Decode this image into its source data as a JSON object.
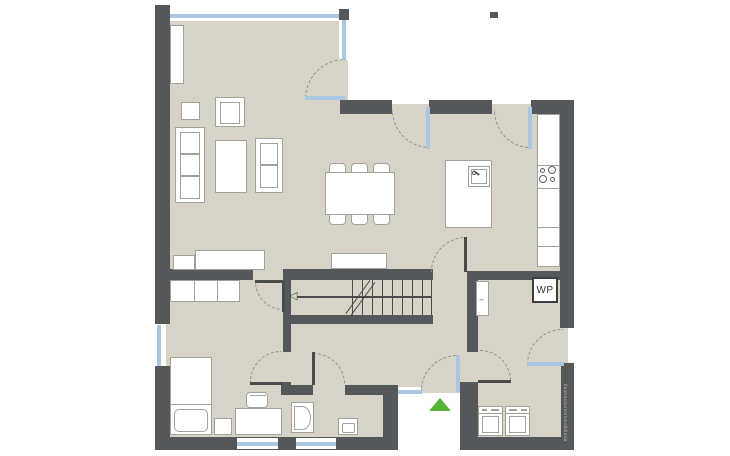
{
  "canvas": {
    "width": 730,
    "height": 456,
    "background": "#ffffff"
  },
  "labels": {
    "heat_pump": "WP",
    "watermark": "ilustracionesinmobiliaria"
  },
  "icons": {
    "stair_direction_arrow": "◁",
    "sliding_door_arrow": "↔"
  },
  "markers": {
    "entrance_triangle_direction": "up",
    "entrance_triangle_color": "#58b434"
  },
  "colors": {
    "wall": "#54585b",
    "floor": "#d7d4c7",
    "window_glass": "#a9c7e1",
    "furniture_border": "#a2a19a",
    "door_arc": "#8e8e86",
    "entrance_green": "#58b434",
    "stair_line": "#4b4b4b",
    "watermark_text": "#c6c4b9",
    "wp_text": "#2e3234"
  }
}
